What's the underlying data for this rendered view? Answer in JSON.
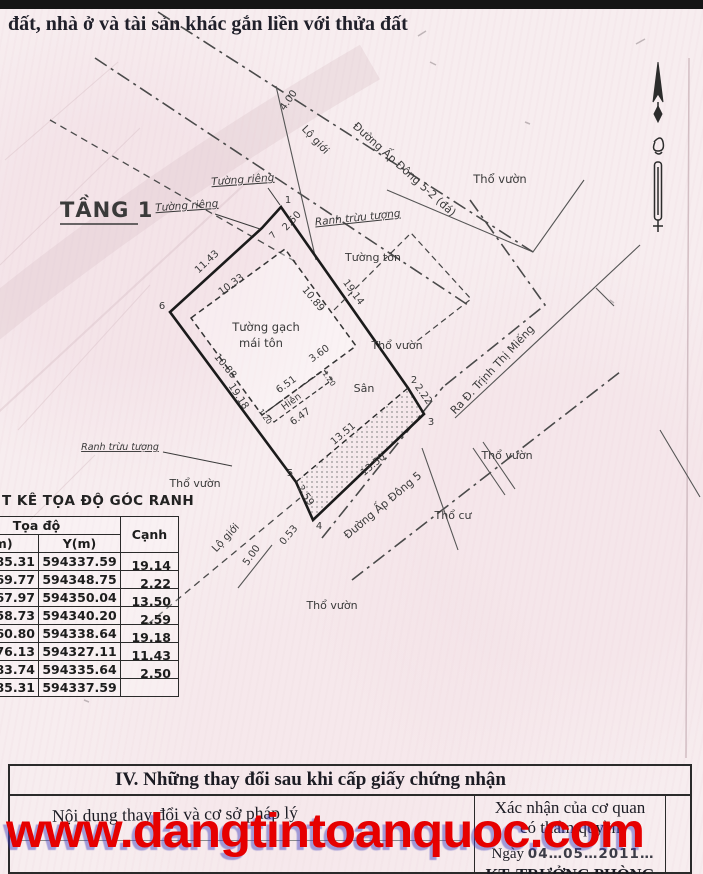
{
  "page": {
    "title_top": "đất, nhà ở và tài sản khác gắn liền với thửa đất"
  },
  "diagram": {
    "floor_label": "TẦNG 1",
    "roads": {
      "road_top": "Đường Ấp Đông 5-2 (đá)",
      "road_bottom": "Đường Ấp Đông 5",
      "road_exit": "Ra Đ. Trịnh Thị Miếng"
    },
    "boundaries": {
      "lo_gioi": "Lộ giới",
      "ranh_truu_tuong": "Ranh trừu tượng",
      "tuong_rieng": "Tường riêng",
      "tuong_ton": "Tường tôn"
    },
    "areas": {
      "tho_vuon": "Thổ vườn",
      "tho_cu": "Thổ cư",
      "san": "Sân",
      "hien": "Hiên",
      "building_line1": "Tường gạch",
      "building_line2": "mái tôn"
    },
    "dims": {
      "d400": "4.00",
      "d250": "2.50",
      "d1143": "11.43",
      "d1914": "19.14",
      "d1033": "10.33",
      "d1089": "10.89",
      "d1088": "10.88",
      "d360": "3.60",
      "d651": "6.51",
      "d647": "6.47",
      "d120": "1.20",
      "d222": "2.22",
      "d1351": "13.51",
      "d1350": "13.50",
      "d259": "2.59",
      "d053": "0.53",
      "d500": "5.00",
      "d1918": "19.18"
    },
    "points": {
      "p1": "1",
      "p2": "2",
      "p3": "3",
      "p4": "4",
      "p5": "5",
      "p6": "6",
      "p7": "7"
    }
  },
  "table": {
    "title": "T KÊ TỌA ĐỘ GÓC RANH",
    "header_group": "Tọa độ",
    "col_x": "X(m)",
    "col_y": "Y(m)",
    "col_edge": "Cạnh",
    "rows": [
      {
        "x": "785.31",
        "y": "594337.59",
        "canh": "19.14"
      },
      {
        "x": "769.77",
        "y": "594348.75",
        "canh": "2.22"
      },
      {
        "x": "767.97",
        "y": "594350.04",
        "canh": "13.50"
      },
      {
        "x": "758.73",
        "y": "594340.20",
        "canh": "2.59"
      },
      {
        "x": "760.80",
        "y": "594338.64",
        "canh": "19.18"
      },
      {
        "x": "776.13",
        "y": "594327.11",
        "canh": "11.43"
      },
      {
        "x": "783.74",
        "y": "594335.64",
        "canh": "2.50"
      },
      {
        "x": "785.31",
        "y": "594337.59",
        "canh": ""
      }
    ]
  },
  "section4": {
    "heading": "IV. Những thay đổi sau khi cấp giấy chứng nhận",
    "left_header": "Nội dung thay đổi và cơ sở pháp lý",
    "right_header_1": "Xác nhận của cơ quan",
    "right_header_2": "có thẩm quyền",
    "date_prefix": "Ngày",
    "date_value": "04…05…2011…",
    "signer": "KT. TRƯỞNG PHÒNG"
  },
  "watermark": {
    "text": "www.dangtintoanquoc.com",
    "color": "#e60000"
  }
}
